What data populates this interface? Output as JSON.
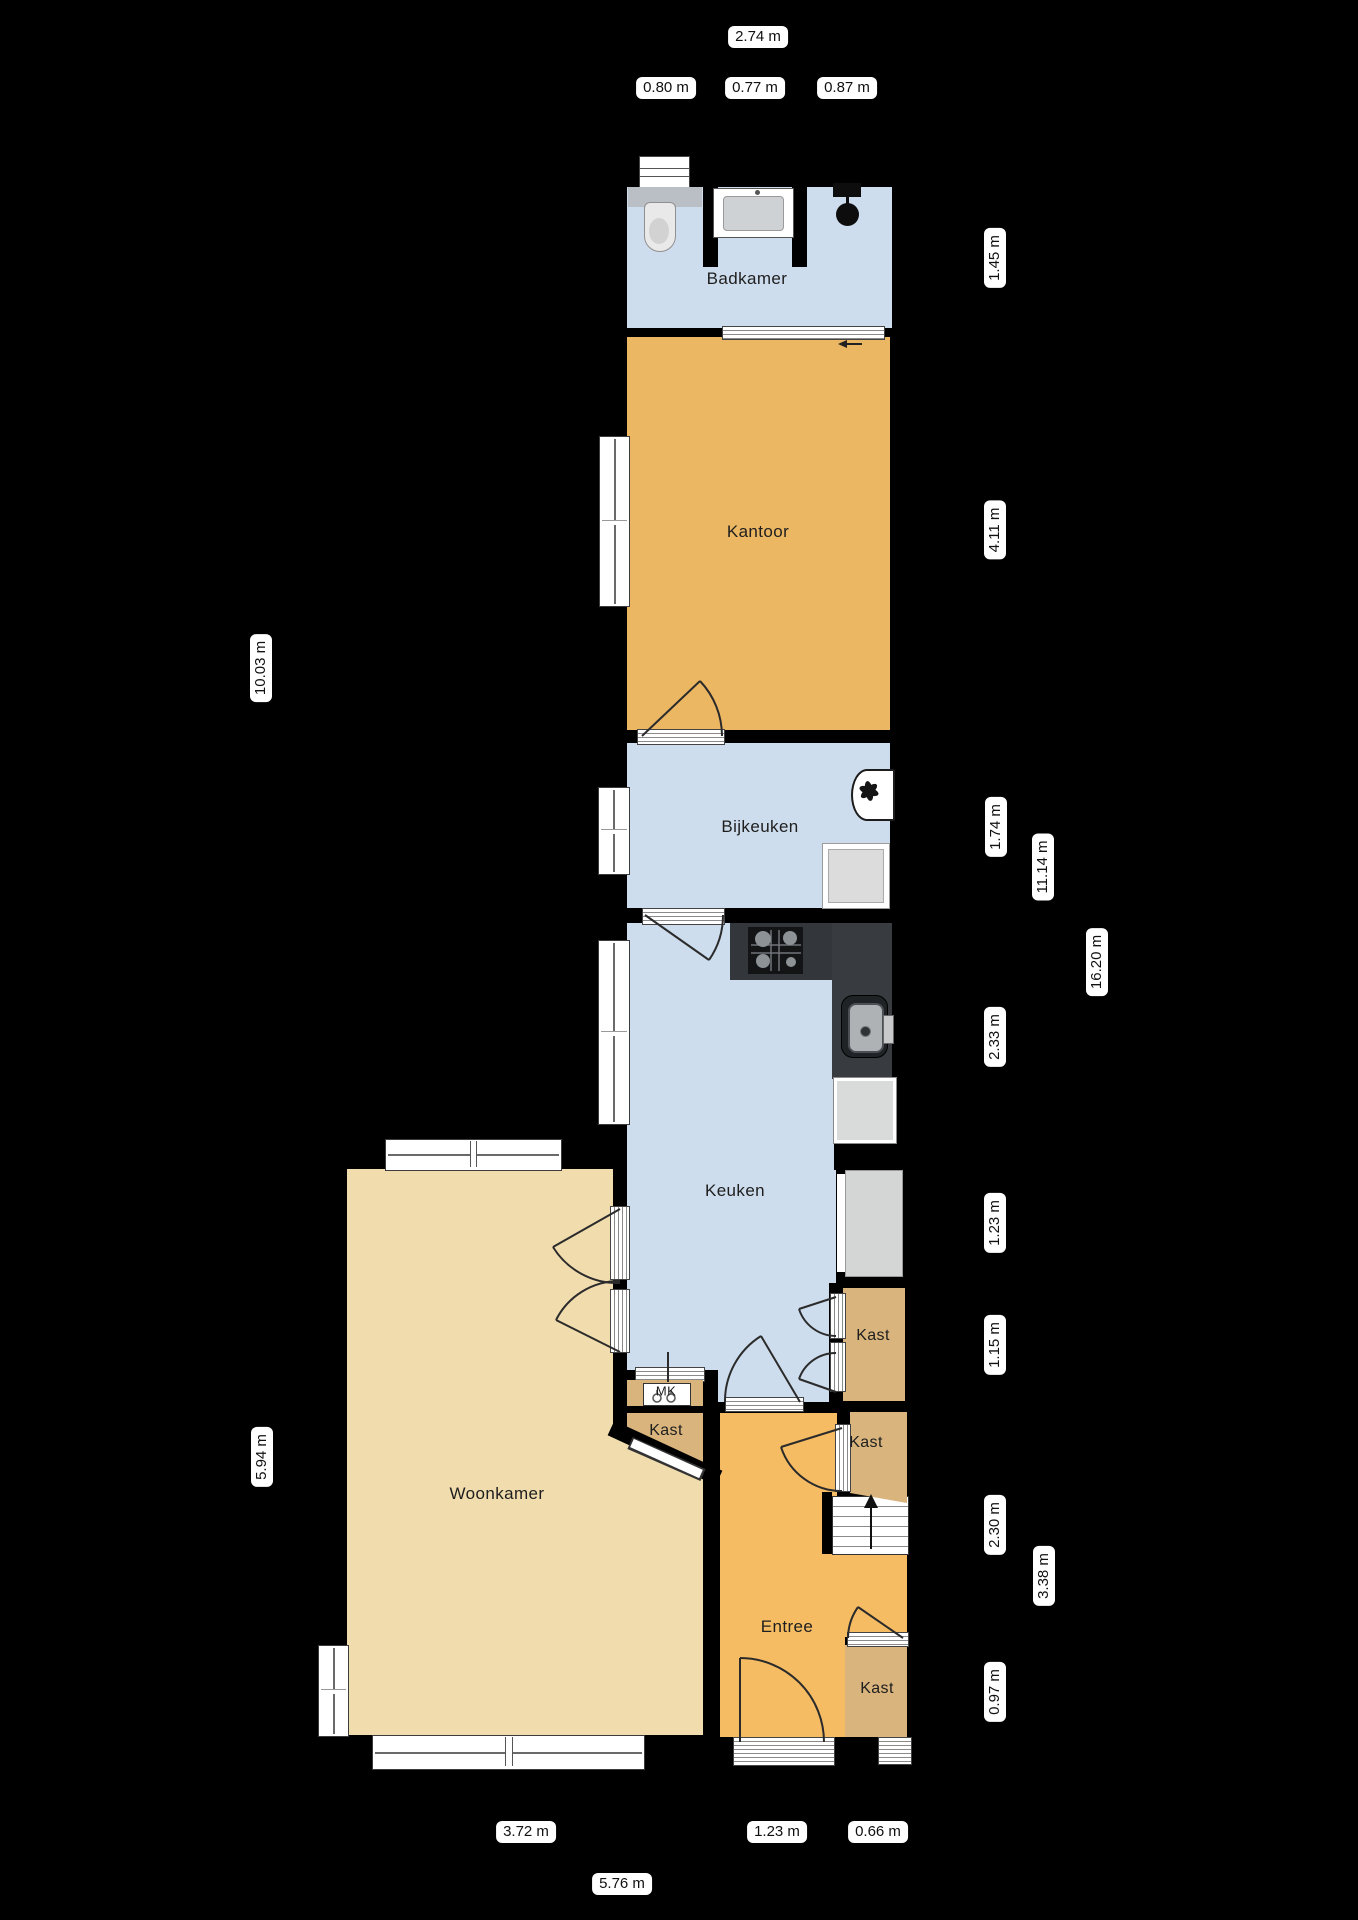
{
  "plan_type": "floorplan",
  "rooms": {
    "badkamer": "Badkamer",
    "kantoor": "Kantoor",
    "bijkeuken": "Bijkeuken",
    "keuken": "Keuken",
    "woonkamer": "Woonkamer",
    "entree": "Entree",
    "kast_keuken": "Kast",
    "kast_hal": "Kast",
    "kast_trap": "Kast",
    "kast_entree": "Kast",
    "meterkast": "MK"
  },
  "dimensions": {
    "top_total": "2.74 m",
    "top_segments": [
      "0.80 m",
      "0.77 m",
      "0.87 m"
    ],
    "right_segments": [
      "1.45 m",
      "4.11 m",
      "1.74 m",
      "2.33 m",
      "1.23 m",
      "1.15 m",
      "2.30 m",
      "0.97 m"
    ],
    "right_totals": [
      "11.14 m",
      "3.38 m",
      "16.20 m"
    ],
    "left_segments": [
      "10.03 m",
      "5.94 m"
    ],
    "bottom_segments": [
      "3.72 m",
      "1.23 m",
      "0.66 m"
    ],
    "bottom_total": "5.76 m"
  },
  "colors": {
    "background": "#000000",
    "wet_room_blue": "#cedded",
    "office_orange": "#ecb763",
    "hall_orange": "#f5bc63",
    "living_tan": "#f1dcae",
    "closet_tan": "#d9b57d",
    "counter_dark": "#33363a",
    "appliance_gray": "#d9dbdb",
    "label_pill": "#ffffff"
  }
}
